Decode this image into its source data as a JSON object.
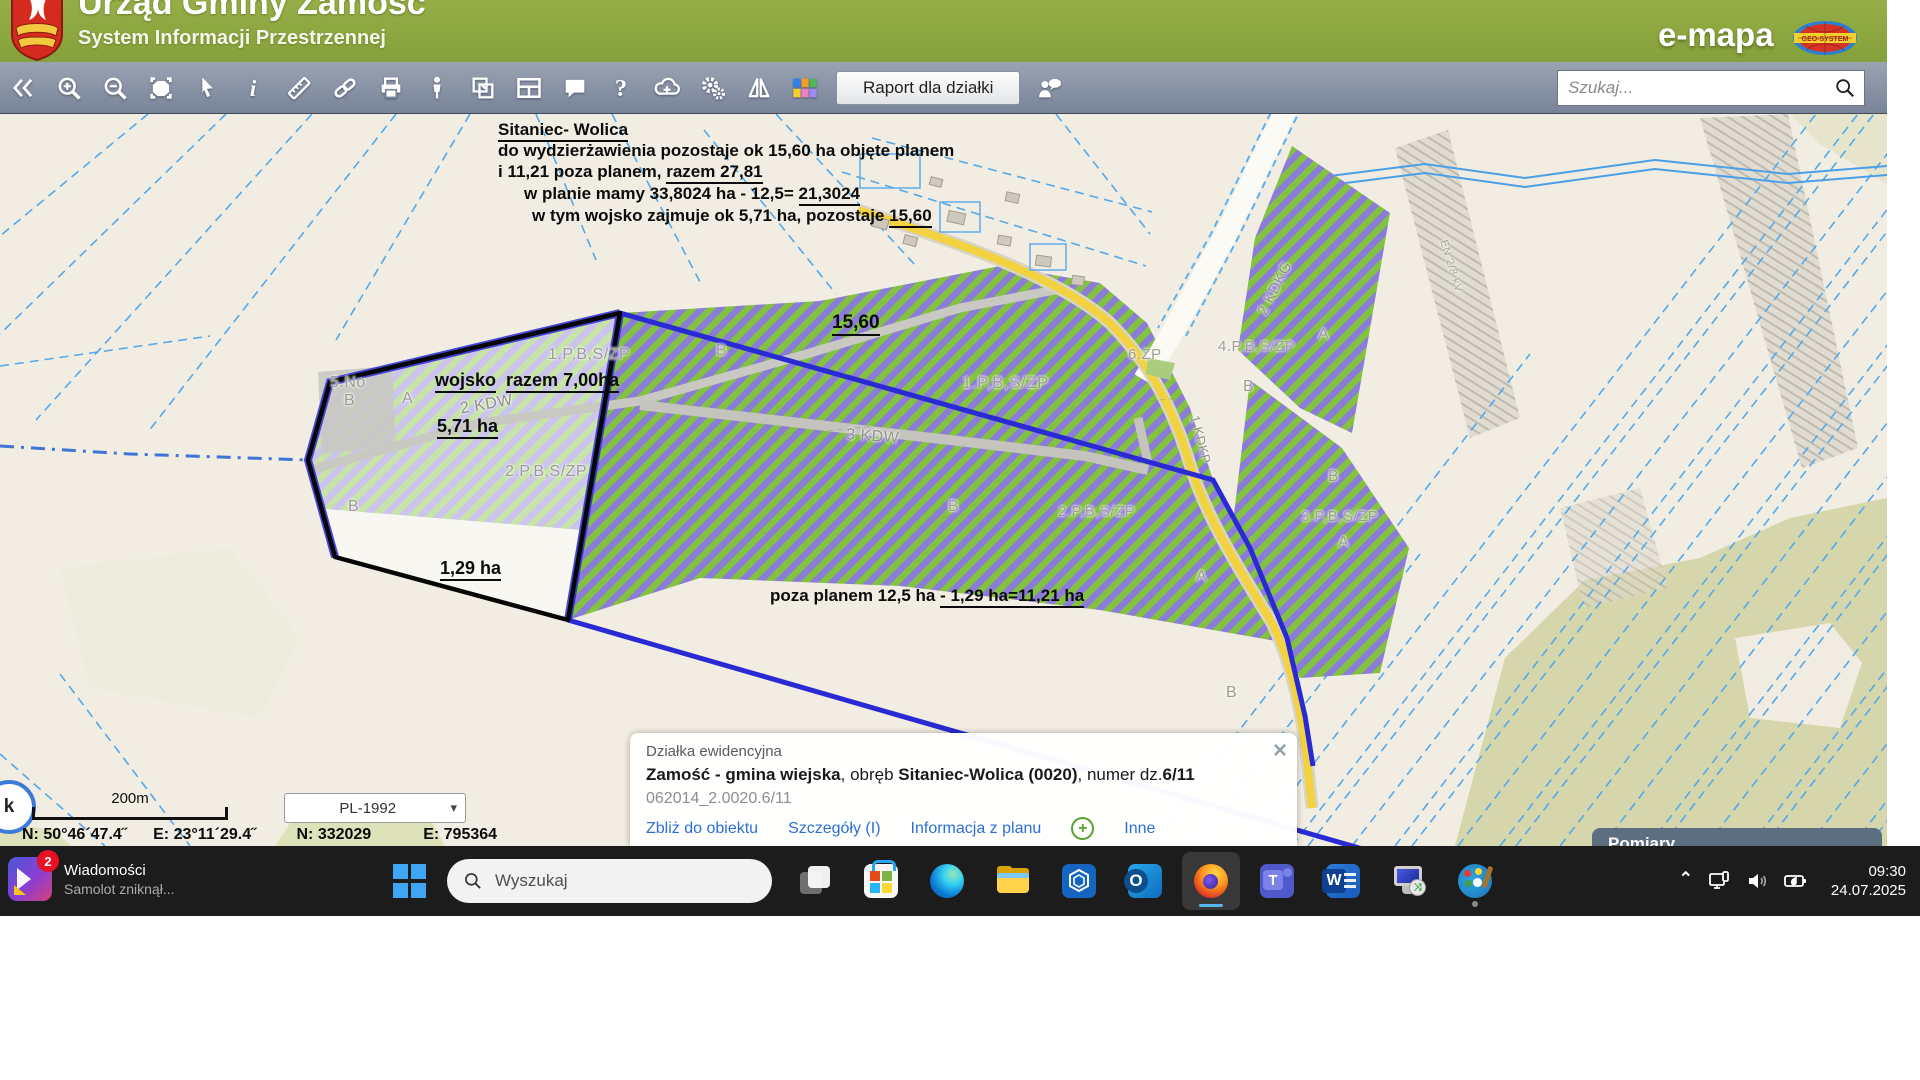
{
  "header": {
    "title": "Urząd Gminy Zamość",
    "subtitle": "System Informacji Przestrzennej",
    "brand": "e-mapa",
    "brand_badge": "GEO-SYSTEM"
  },
  "toolbar": {
    "report_button": "Raport dla działki",
    "search_placeholder": "Szukaj...",
    "icons": [
      "collapse-left",
      "zoom-in",
      "zoom-out",
      "select-area",
      "pointer",
      "info",
      "measure",
      "link",
      "print",
      "street-view",
      "copy-map",
      "layout",
      "comment",
      "help",
      "download",
      "settings",
      "compare",
      "legend",
      "feedback-person"
    ]
  },
  "notes": {
    "title": "Sitaniec- Wolica",
    "line1": "do wydzierżawienia pozostaje ok 15,60 ha objęte planem",
    "line2_a": "i 11,21 poza planem,",
    "line2_b": "razem 27,81",
    "line3_a": "w planie mamy 33,8024 ha - 12,5=",
    "line3_b": "21,3024",
    "line4_a": "w tym wojsko zajmuje ok 5,71 ha, pozostaje",
    "line4_b": "15,60",
    "area1560": "15,60",
    "wojsko_a": "wojsko",
    "wojsko_b": "razem 7,00ha",
    "area571": "5,71 ha",
    "area129": "1,29 ha",
    "poza_a": "poza planem 12,5 ha",
    "poza_b": "- 1,29 ha=11,21 ha"
  },
  "map": {
    "labels": [
      "1.P,B,S/ZP",
      "2.P,B,S/ZP",
      "1.P,B,S/ZP",
      "2.P,B,S/ZP",
      "3 KDW",
      "2 KDW",
      "5.No",
      "B",
      "A",
      "B",
      "B",
      "B",
      "A",
      "6.ZP",
      "4.P,B,S/ZP",
      "A",
      "B",
      "3.P,B,S/ZP",
      "B",
      "A",
      "2 KDKG",
      "1 KDKP",
      "B",
      "EN 2/8 kV"
    ]
  },
  "info_panel": {
    "type_label": "Działka ewidencyjna",
    "name_bold1": "Zamość - gmina wiejska",
    "name_mid1": ", obręb ",
    "name_bold2": "Sitaniec-Wolica (0020)",
    "name_mid2": ", numer dz.",
    "name_bold3": "6/11",
    "id": "062014_2.0020.6/11",
    "links": [
      "Zbliż do obiektu",
      "Szczegóły (I)",
      "Informacja z planu",
      "Inne"
    ],
    "close_icon": "×"
  },
  "status_bar": {
    "scale_label": "200m",
    "crs": "PL-1992",
    "crs_chevron": "▾",
    "history_button": "k",
    "coords": [
      "N: 50°46´47.4˝",
      "E: 23°11´29.4˝",
      "N: 332029",
      "E: 795364"
    ]
  },
  "measure_panel": {
    "title": "Pomiary"
  },
  "taskbar": {
    "widget": {
      "badge": "2",
      "title": "Wiadomości",
      "subtitle": "Samolot zniknął..."
    },
    "search_label": "Wyszukaj",
    "icons": [
      "task-view",
      "store",
      "edge",
      "explorer",
      "cube-app",
      "outlook",
      "firefox",
      "teams",
      "word",
      "remote-desktop",
      "paint"
    ],
    "clock": {
      "time": "09:30",
      "date": "24.07.2025"
    }
  },
  "colors": {
    "accent_green": "#85a13b",
    "stripe_green": "#83c23e",
    "stripe_purple": "#8b7cd9",
    "selection_blue": "#2a2ad4",
    "taskbar": "#1c1c1c"
  }
}
